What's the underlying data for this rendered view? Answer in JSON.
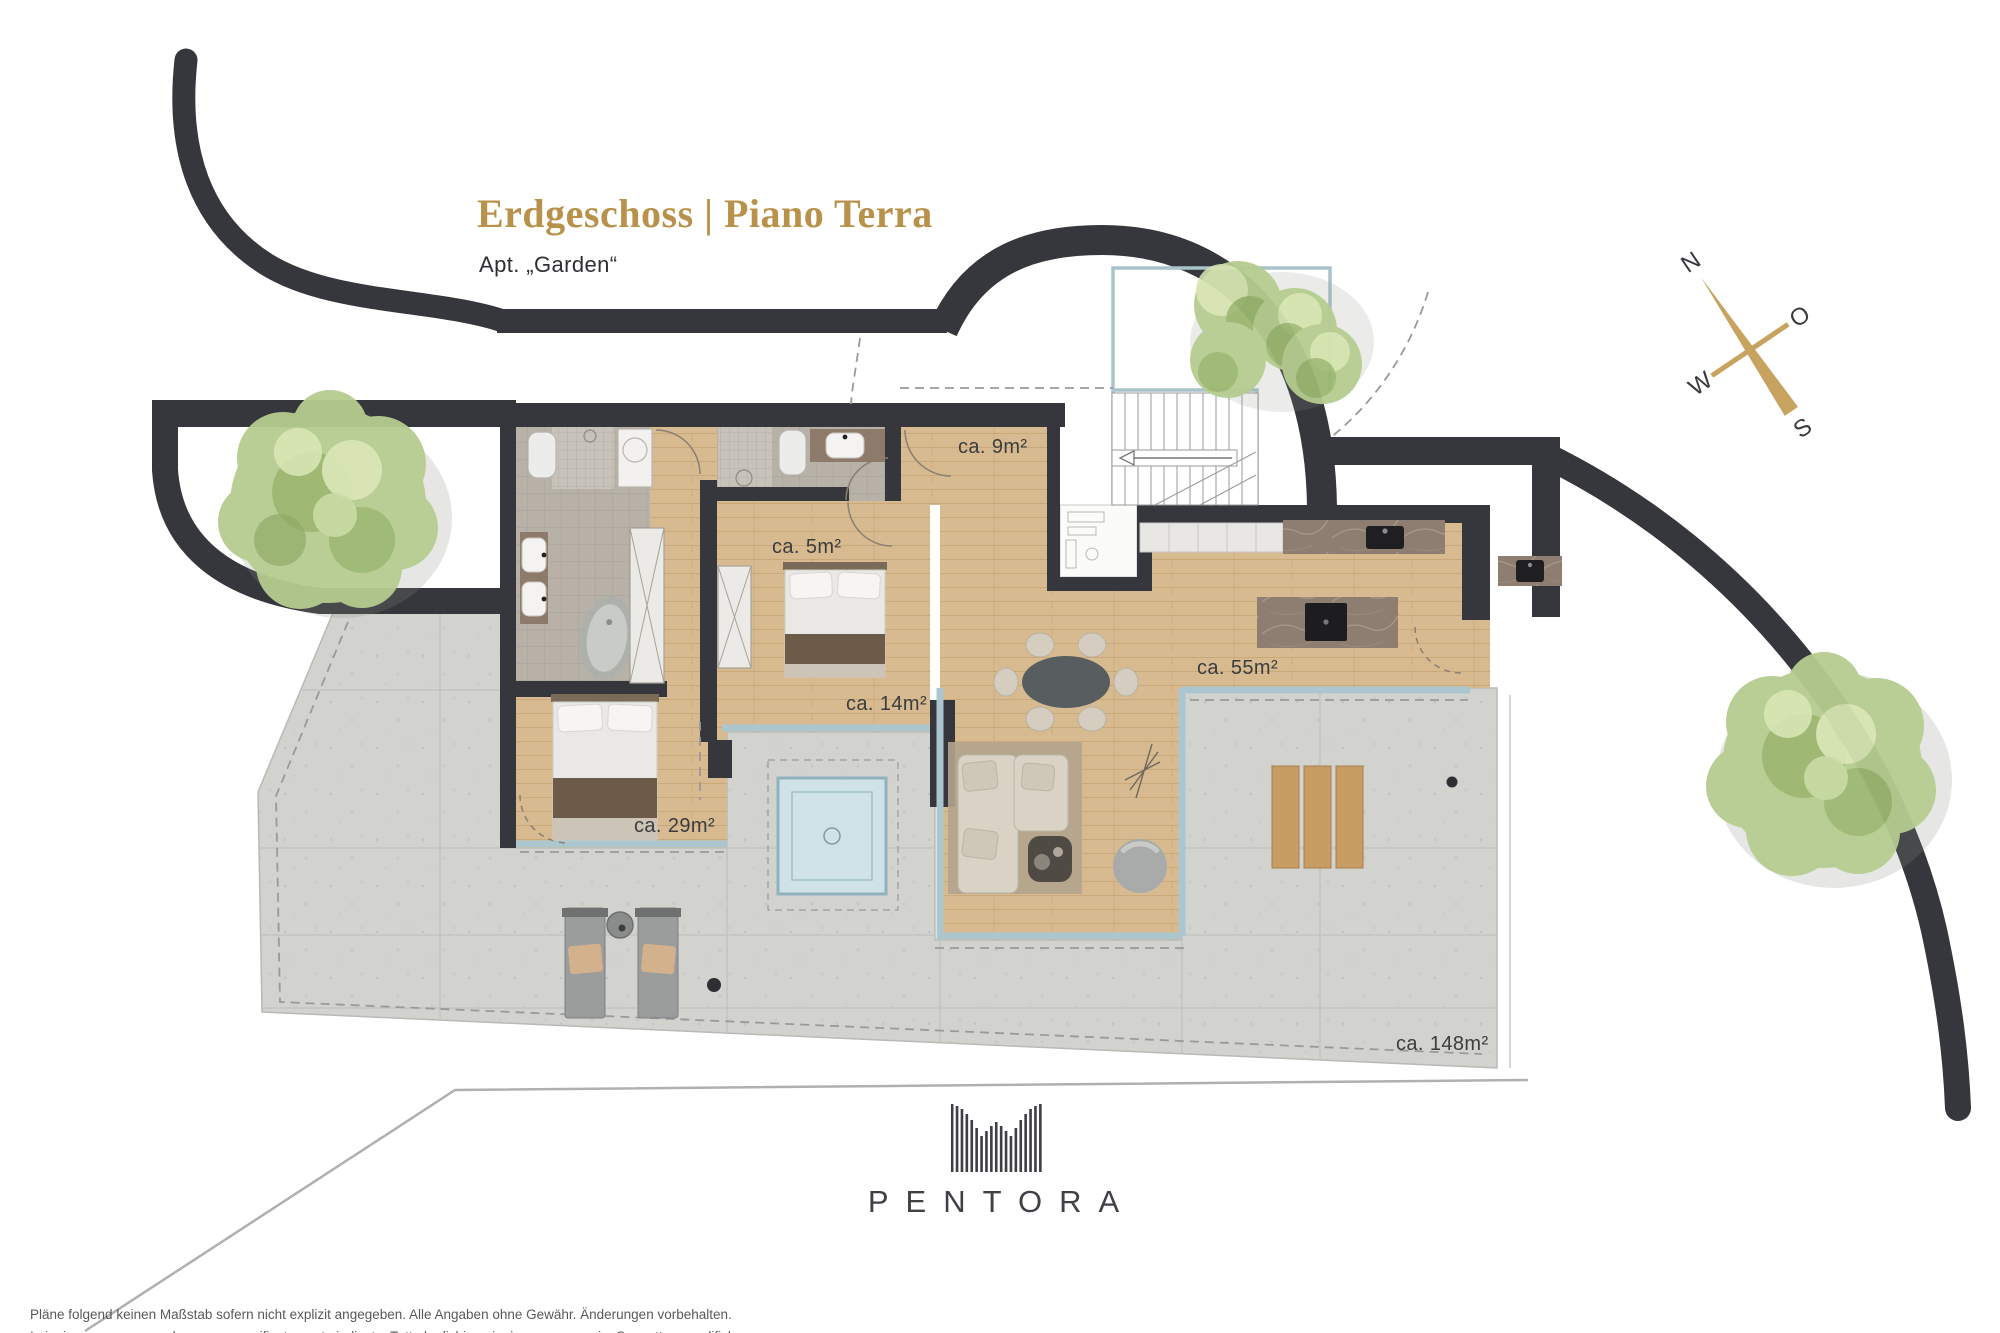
{
  "header": {
    "title": "Erdgeschoss | Piano Terra",
    "subtitle": "Apt. „Garden“"
  },
  "rooms": {
    "entry": {
      "label": "ca. 9m²"
    },
    "bath": {
      "label": "ca. 5m²"
    },
    "bedroom_small": {
      "label": "ca. 14m²"
    },
    "living": {
      "label": "ca. 55m²"
    },
    "bedroom_master": {
      "label": "ca. 29m²"
    },
    "terrace": {
      "label": "ca. 148m²"
    }
  },
  "compass": {
    "north": "N",
    "east": "O",
    "south": "S",
    "west": "W"
  },
  "logo": {
    "name": "PENTORA"
  },
  "footer": {
    "line1": "Pläne folgend keinen Maßstab sofern nicht explizit angegeben. Alle Angaben ohne Gewähr. Änderungen vorbehalten.",
    "line2": "I piani non seguono scala se non specificatamente indicato. Tutte le dichiarazioni senza garanzia. Soggetto a modifiche."
  },
  "colors": {
    "accent_gold": "#b8924a",
    "compass_needle": "#c8a25f",
    "wall": "#36373d",
    "wood_floor": "#d7ba90",
    "bath_floor": "#b7b1a8",
    "terrace": "#d2d3cf",
    "glass": "#abc6ce",
    "tree": "#b6cc8f",
    "pool": "#cfe2e8"
  }
}
